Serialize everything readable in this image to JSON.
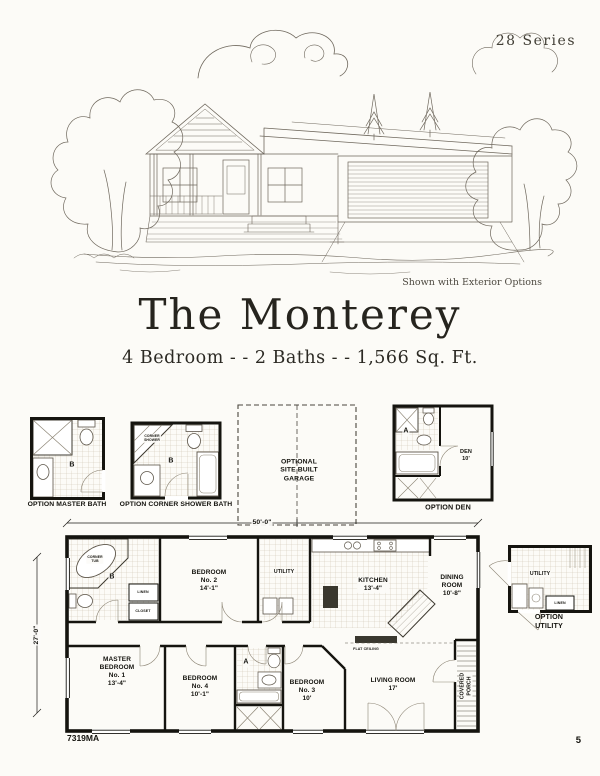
{
  "page": {
    "series": "28 Series",
    "page_number": "5",
    "model_number": "7319MA"
  },
  "elevation": {
    "caption": "Shown with Exterior Options"
  },
  "header": {
    "title": "The Monterey",
    "subtitle": "4 Bedroom - - 2 Baths - - 1,566 Sq. Ft."
  },
  "options": {
    "master_bath": {
      "caption": "OPTION MASTER BATH",
      "letter": "B"
    },
    "corner_shower_bath": {
      "caption": "OPTION CORNER SHOWER BATH",
      "letter": "B",
      "shower": "CORNER\nSHOWER"
    },
    "garage": {
      "text": "OPTIONAL\nSITE BUILT\nGARAGE"
    },
    "den": {
      "caption": "OPTION DEN",
      "letter": "A",
      "room": "DEN\n10'"
    },
    "utility": {
      "caption": "OPTION UTILITY",
      "room": "UTILITY",
      "linen": "LINEN"
    }
  },
  "plan": {
    "width_dim": "50'-0\"",
    "depth_dim": "27'-0\"",
    "rooms": {
      "master_bedroom": "MASTER\nBEDROOM\nNo. 1\n13'-4\"",
      "bedroom_2": "BEDROOM\nNo. 2\n14'-1\"",
      "bedroom_3": "BEDROOM\nNo. 3\n10'",
      "bedroom_4": "BEDROOM\nNo. 4\n10'-1\"",
      "kitchen": "KITCHEN\n13'-4\"",
      "dining_room": "DINING\nROOM\n10'-8\"",
      "living_room": "LIVING ROOM\n17'",
      "utility": "UTILITY",
      "covered_porch": "COVERED\nPORCH",
      "bath_a": "A",
      "bath_b": "B",
      "linen": "LINEN",
      "closet": "CLOSET",
      "corner_tub": "CORNER\nTUB",
      "flat_ceiling": "FLAT CEILING"
    }
  }
}
